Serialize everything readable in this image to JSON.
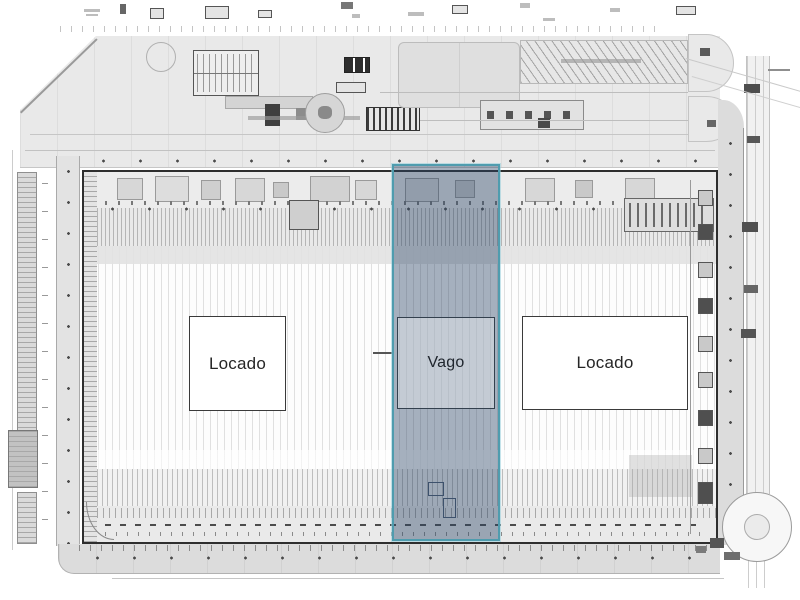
{
  "plan": {
    "units": [
      {
        "label": "Locado"
      },
      {
        "label": "Vago"
      },
      {
        "label": "Locado"
      }
    ],
    "highlight": {
      "unit": "Vago",
      "border_color": "#4f9cae",
      "fill_color": "rgba(44,68,102,0.42)"
    },
    "drawing": {
      "outline_color": "#2e2e2e",
      "paving_color": "#dcdcdc",
      "background_color": "#ffffff"
    }
  }
}
